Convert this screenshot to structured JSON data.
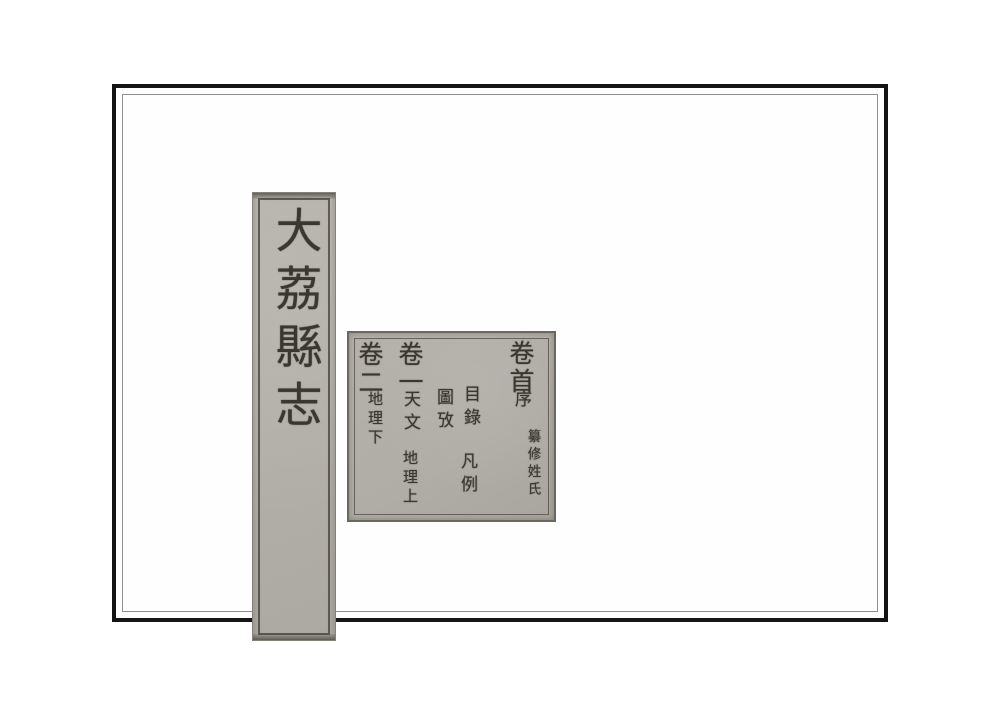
{
  "colors": {
    "paper": "#b3b0a9",
    "ink": "#3a372f",
    "frame_border": "#141414",
    "page_background": "#ffffff"
  },
  "spine": {
    "title": "大荔縣志"
  },
  "toc": {
    "volume_head": {
      "label": "卷首",
      "preface": "序",
      "compilers": "纂修姓氏"
    },
    "front_matter": {
      "contents": "目錄",
      "conventions": "凡例",
      "illustrations": "圖攷"
    },
    "volume_one": {
      "label": "卷一",
      "astronomy": "天文",
      "geography_upper": "地理上"
    },
    "volume_two": {
      "label": "卷二",
      "geography_lower": "地理下"
    }
  }
}
